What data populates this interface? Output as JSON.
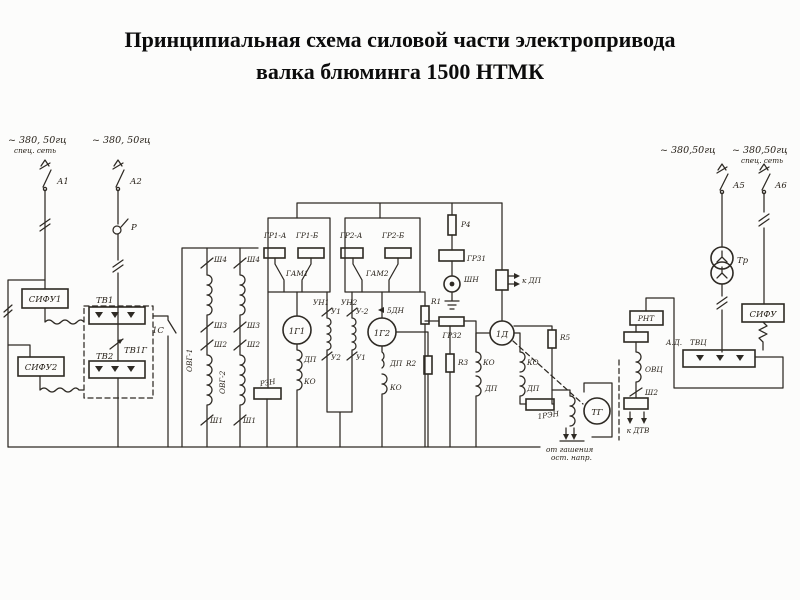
{
  "title": {
    "line1": "Принципиальная схема силовой части электропривода",
    "line2": "валка блюминга 1500 НТМК"
  },
  "labels": {
    "supply_l1": "~ 380, 50гц",
    "supply_l1_sub": "спец. сеть",
    "supply_l2": "~ 380, 50гц",
    "a1": "А1",
    "a2": "А2",
    "p": "Р",
    "sifu1": "СИФУ1",
    "sifu2": "СИФУ2",
    "tv1": "ТВ1",
    "tv2": "ТВ2",
    "tv1g": "ТВ1Г",
    "c1s": "1С",
    "ovg1": "ОВГ-1",
    "ovg2": "ОВГ-2",
    "sh4_1": "Ш4",
    "sh4_2": "Ш4",
    "sh3_1": "Ш3",
    "sh3_2": "Ш3",
    "sh2_1": "Ш2",
    "sh2_2": "Ш2",
    "sh1_1": "Ш1",
    "sh1_2": "Ш1",
    "gr1a": "ГР1-А",
    "gr1b": "ГР1-Б",
    "gr2a": "ГР2-А",
    "gr2b": "ГР2-Б",
    "gam1": "ГАМ1",
    "gam2": "ГАМ2",
    "g1": "1Г1",
    "g2": "1Г2",
    "un1": "УН1",
    "un2": "УН2",
    "u1t": "У1",
    "u2t": "У-2",
    "u2b": "У2",
    "u1b": "У1",
    "dn5": "5ДН",
    "dp_g1": "ДП",
    "ko_g1": "КО",
    "rzn": "РЗН",
    "dp_g2": "ДП",
    "r2": "R2",
    "ko_g2": "КО",
    "r4": "Р4",
    "gr31": "ГР31",
    "shn": "ШН",
    "k_dp": "к ДП",
    "r1": "R1",
    "gr32": "ГР32",
    "r3": "R3",
    "d1": "1Д",
    "ko_d_l": "КО",
    "dp_d_l": "ДП",
    "ko_d_r": "КО",
    "dp_d_r": "ДП",
    "r5": "R5",
    "ren1": "1РЭН",
    "tg": "ТГ",
    "quench1": "от гашения",
    "quench2": "ост. напр.",
    "supply_r1": "~ 380,50гц",
    "supply_r2": "~ 380,50гц",
    "supply_r2_sub": "спец. сеть",
    "a5": "А5",
    "a6": "А6",
    "tr": "Тр",
    "sifu3": "СИФУ",
    "rnt": "РНТ",
    "ovc": "ОВЦ",
    "sh2_r": "Ш2",
    "k_dtv": "к ДТВ",
    "ad": "А.Д.",
    "tvc": "ТВЦ"
  }
}
